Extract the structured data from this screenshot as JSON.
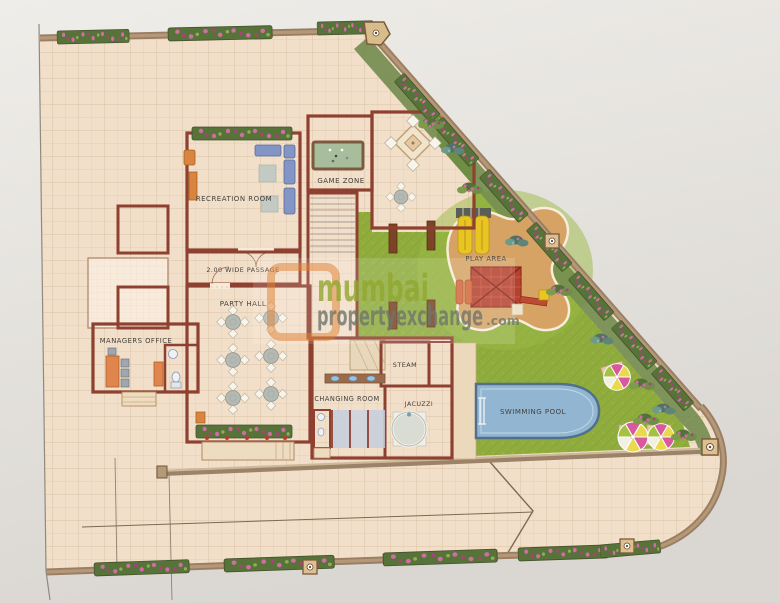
{
  "plan": {
    "labels": {
      "recreation_room": "RECREATION ROOM",
      "game_zone": "GAME ZONE",
      "passage": "2.00 WIDE PASSAGE",
      "party_hall": "PARTY HALL",
      "managers_office": "MANAGERS OFFICE",
      "play_area": "PLAY AREA",
      "steam": "STEAM",
      "changing_room": "CHANGING ROOM",
      "jacuzzi": "JACUZZI",
      "swimming_pool": "SWIMMING POOL"
    }
  },
  "watermark": {
    "line1": "mumbai",
    "line2": "propertyexchange",
    "suffix": ".com"
  },
  "colors": {
    "wall": "#8e4130",
    "ground": "#f1dfc9",
    "room": "#f8ebdc",
    "lawn": "#8fac3d",
    "sand": "#d6a365",
    "pool": "#92b6d1",
    "pool_border": "#50708e",
    "wm_orange": "#e2802f",
    "wm_green": "#91a82f",
    "wm_gray": "#70766a",
    "label": "#44403b",
    "flower_pink": "#cf6da4",
    "paper": "#eceae6",
    "wall_band": "#9a7e64"
  }
}
